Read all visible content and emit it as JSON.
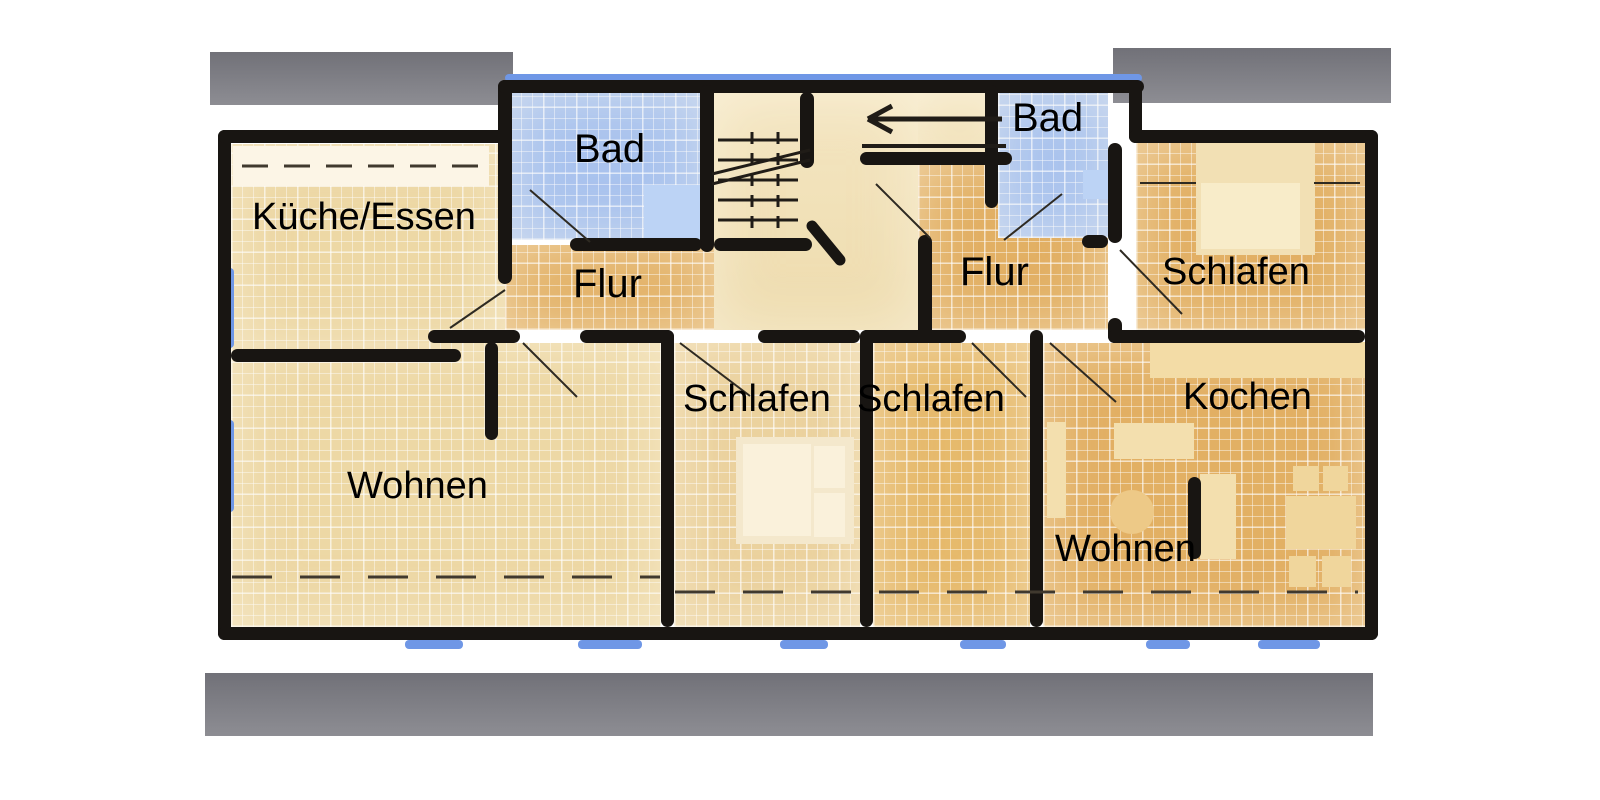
{
  "plan": {
    "type": "floor-plan",
    "floor_description": "upper floor with two apartments and central staircase"
  },
  "rooms": {
    "kueche": {
      "label": "Küche/Essen"
    },
    "bad_left": {
      "label": "Bad"
    },
    "flur_left": {
      "label": "Flur"
    },
    "wohnen_left": {
      "label": "Wohnen"
    },
    "schlafen_mid_left": {
      "label": "Schlafen"
    },
    "schlafen_mid_right": {
      "label": "Schlafen"
    },
    "bad_right": {
      "label": "Bad"
    },
    "flur_right": {
      "label": "Flur"
    },
    "schlafen_right": {
      "label": "Schlafen"
    },
    "wohnen_right": {
      "label": "Wohnen"
    },
    "kochen": {
      "label": "Kochen"
    }
  },
  "colors": {
    "floor_light": "#edd8a5",
    "floor_orange": "#e2b064",
    "bath_blue": "#a9c3ee",
    "window_blue": "#6f97e6",
    "wall_black": "#181512",
    "balcony_gray": "#808086",
    "label_gray": "#6b7584"
  }
}
